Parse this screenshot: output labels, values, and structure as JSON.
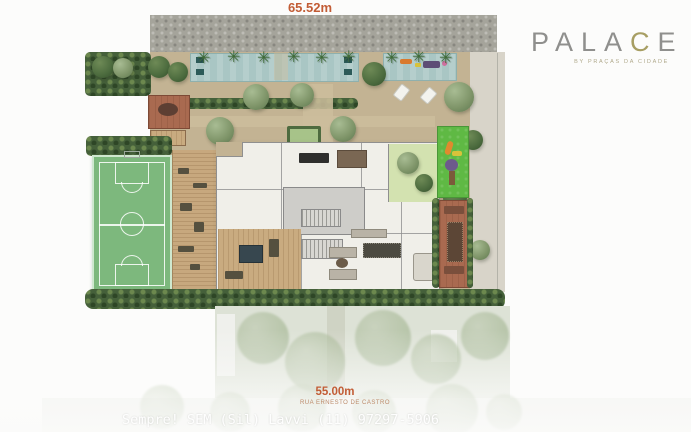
{
  "dimensions": {
    "top": "65.52m",
    "bottom": "55.00m",
    "street_name": "RUA ERNESTO DE CASTRO"
  },
  "logo": {
    "part1": "PALA",
    "part2": "C",
    "part3": "E",
    "subtitle": "BY PRAÇAS DA CIDADE"
  },
  "watermark": "Sempre! SEM (Sil) Lavvi (11) 97297-5906",
  "icons": [
    "compass-icon",
    "palm-icon",
    "tree-icon"
  ],
  "colors": {
    "dimension_label": "#c25c35",
    "logo_gray": "#8f8f8d",
    "logo_accent": "#a79e63",
    "court_green": "#7db87d",
    "pool_teal": "#a9c6c4",
    "playground_green": "#5fb944",
    "terracotta": "#a96a50",
    "deck_tan": "#c3b393",
    "hedge_green": "#45603a",
    "gravel_gray": "#a5a49b"
  }
}
